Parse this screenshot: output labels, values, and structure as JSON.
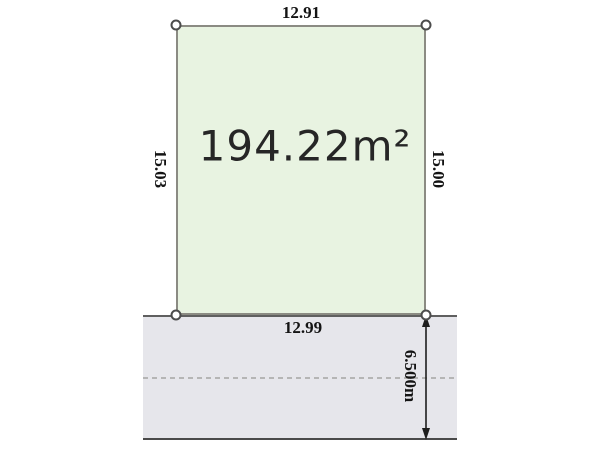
{
  "diagram": {
    "area_label": "194.22m²",
    "dimensions": {
      "top": "12.91",
      "left": "15.03",
      "right": "15.00",
      "bottom": "12.99",
      "road_width": "6.500m"
    },
    "colors": {
      "plot_fill": "#e8f3e1",
      "plot_border": "#8b8b83",
      "road_fill": "#e6e6eb",
      "road_line": "#5f5f5f",
      "road_centerline": "#b5b5b5",
      "dimension_text": "#141414",
      "arrow": "#1e1e1e"
    }
  }
}
